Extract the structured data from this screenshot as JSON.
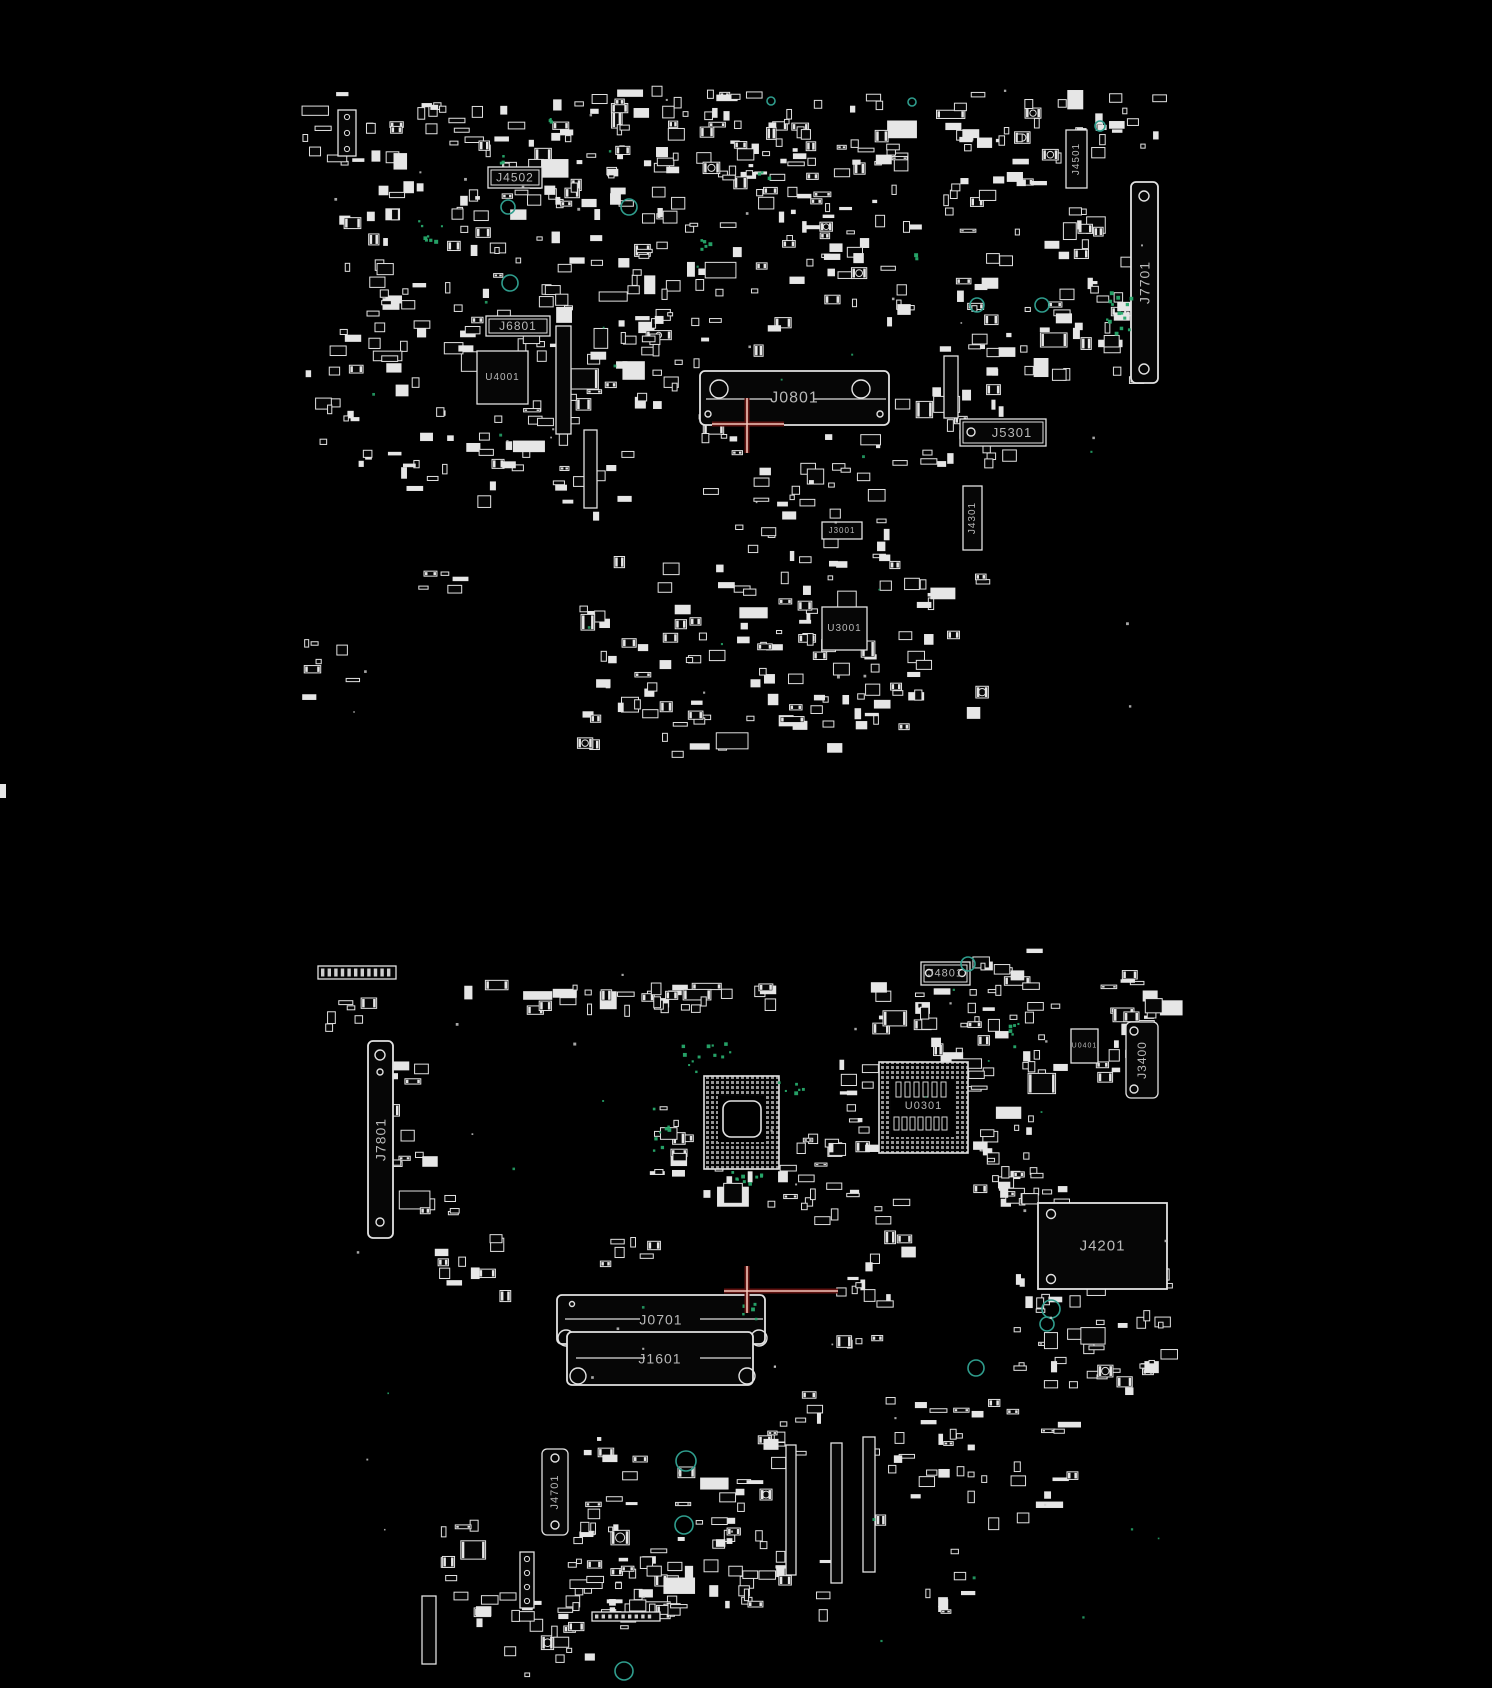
{
  "canvas": {
    "width": 1492,
    "height": 1688,
    "background": "#000000"
  },
  "palette": {
    "outline": "#e2e2e2",
    "fill_dim": "#060606",
    "label": "#b9b9b9",
    "ring_teal": "#2f9d8d",
    "dot_green": "#27a96c",
    "crosshair_core": "#f3c5b9",
    "crosshair_glow": "#5f1210"
  },
  "edge_marks": [
    [
      0,
      784,
      6,
      14
    ]
  ],
  "boards": [
    {
      "name": "top-side",
      "components": [
        {
          "label": "J4502",
          "kind": "labelbox",
          "dbl": true,
          "x": 488,
          "y": 167,
          "w": 54,
          "h": 21,
          "fs": 12
        },
        {
          "label": "J6801",
          "kind": "labelbox",
          "dbl": true,
          "x": 486,
          "y": 316,
          "w": 64,
          "h": 20,
          "fs": 12
        },
        {
          "label": "U4001",
          "kind": "chip",
          "x": 477,
          "y": 351,
          "w": 51,
          "h": 53,
          "fs": 10
        },
        {
          "label": "J0801",
          "kind": "sodimm",
          "x": 700,
          "y": 371,
          "w": 189,
          "h": 54,
          "fs": 16,
          "circles": [
            [
              719,
              389,
              9
            ],
            [
              861,
              389,
              9
            ],
            [
              708,
              414,
              3
            ],
            [
              880,
              414,
              3
            ]
          ],
          "lines": [
            [
              706,
              399,
              772,
              399
            ],
            [
              814,
              399,
              886,
              399
            ]
          ]
        },
        {
          "label": "J3001",
          "kind": "labelbox",
          "x": 822,
          "y": 522,
          "w": 40,
          "h": 17,
          "fs": 8
        },
        {
          "label": "U3001",
          "kind": "chip",
          "x": 822,
          "y": 607,
          "w": 45,
          "h": 43,
          "fs": 10
        },
        {
          "label": "J5301",
          "kind": "labelbox",
          "dbl": true,
          "x": 960,
          "y": 419,
          "w": 86,
          "h": 27,
          "fs": 13,
          "circles": [
            [
              971,
              432,
              4
            ]
          ],
          "lx": 1012
        },
        {
          "label": "J4301",
          "kind": "vbox",
          "x": 963,
          "y": 486,
          "w": 19,
          "h": 64,
          "fs": 10
        },
        {
          "label": "J4501",
          "kind": "vbox",
          "x": 1066,
          "y": 130,
          "w": 21,
          "h": 58,
          "fs": 10
        },
        {
          "label": "J7701",
          "kind": "vheader",
          "x": 1131,
          "y": 182,
          "w": 27,
          "h": 201,
          "fs": 14,
          "circles": [
            [
              1144,
              196,
              5
            ],
            [
              1144,
              369,
              5
            ]
          ]
        }
      ],
      "crosshair": {
        "x": 747,
        "y": 424,
        "left": 35,
        "right": 37,
        "up": 26,
        "down": 29
      },
      "rings": [
        [
          508,
          207,
          7
        ],
        [
          629,
          207,
          8
        ],
        [
          510,
          283,
          8
        ],
        [
          977,
          305,
          7
        ],
        [
          1042,
          305,
          7
        ],
        [
          912,
          102,
          4
        ],
        [
          1100,
          126,
          5
        ],
        [
          771,
          101,
          4
        ]
      ],
      "green_regions": [
        [
          418,
          218,
          26,
          26,
          8,
          301
        ],
        [
          1106,
          288,
          24,
          44,
          14,
          302
        ],
        [
          694,
          236,
          18,
          18,
          5,
          303
        ],
        [
          497,
          153,
          8,
          12,
          3,
          304
        ],
        [
          545,
          118,
          10,
          8,
          3,
          305
        ],
        [
          756,
          170,
          14,
          10,
          3,
          306
        ],
        [
          905,
          250,
          12,
          10,
          3,
          307
        ]
      ],
      "green_sparse": {
        "count": 14,
        "region": [
          330,
          90,
          820,
          620
        ],
        "seed": 21
      },
      "white_dots": {
        "count": 26,
        "region": [
          300,
          86,
          860,
          640
        ],
        "seed": 7
      },
      "bars": [
        [
          556,
          326,
          15,
          108,
          0
        ],
        [
          584,
          430,
          13,
          78,
          0
        ],
        [
          944,
          356,
          14,
          62,
          0
        ],
        [
          338,
          110,
          18,
          46,
          1
        ]
      ],
      "clusters": [
        [
          300,
          92,
          70,
          72,
          10,
          101
        ],
        [
          365,
          96,
          200,
          122,
          55,
          102
        ],
        [
          560,
          86,
          120,
          130,
          40,
          103
        ],
        [
          660,
          90,
          250,
          140,
          90,
          104
        ],
        [
          935,
          90,
          165,
          130,
          40,
          105
        ],
        [
          1085,
          92,
          70,
          65,
          12,
          106
        ],
        [
          330,
          215,
          240,
          138,
          60,
          107
        ],
        [
          575,
          235,
          215,
          125,
          45,
          108
        ],
        [
          800,
          228,
          110,
          95,
          20,
          109
        ],
        [
          950,
          215,
          175,
          155,
          48,
          110
        ],
        [
          300,
          352,
          115,
          135,
          22,
          111
        ],
        [
          420,
          388,
          150,
          115,
          28,
          112
        ],
        [
          556,
          330,
          70,
          190,
          16,
          113
        ],
        [
          622,
          336,
          95,
          82,
          15,
          114
        ],
        [
          890,
          342,
          115,
          120,
          26,
          115
        ],
        [
          700,
          432,
          185,
          125,
          38,
          116
        ],
        [
          575,
          556,
          215,
          162,
          50,
          117
        ],
        [
          795,
          556,
          185,
          165,
          48,
          118
        ],
        [
          575,
          690,
          170,
          66,
          15,
          119
        ],
        [
          770,
          690,
          130,
          62,
          13,
          120
        ],
        [
          300,
          606,
          56,
          92,
          7,
          121
        ],
        [
          418,
          568,
          42,
          42,
          5,
          122
        ],
        [
          1088,
          295,
          48,
          88,
          8,
          123
        ]
      ]
    },
    {
      "name": "bottom-side",
      "components": [
        {
          "label": "J4801",
          "kind": "labelbox",
          "dbl": true,
          "x": 921,
          "y": 962,
          "w": 49,
          "h": 23,
          "fs": 11,
          "circles": [
            [
              929,
              973,
              3.5
            ],
            [
              962,
              973,
              3.5
            ]
          ]
        },
        {
          "label": "U0401",
          "kind": "chip",
          "x": 1071,
          "y": 1029,
          "w": 27,
          "h": 34,
          "fs": 7
        },
        {
          "label": "J3400",
          "kind": "vheader",
          "x": 1126,
          "y": 1022,
          "w": 32,
          "h": 76,
          "fs": 12,
          "circles": [
            [
              1134,
              1031,
              4
            ],
            [
              1134,
              1089,
              4
            ]
          ]
        },
        {
          "label": "U0301",
          "kind": "bga",
          "x": 879,
          "y": 1062,
          "w": 89,
          "h": 91,
          "fs": 11,
          "ly": 1106,
          "inner_fill": [
            891,
            1079,
            64,
            58
          ],
          "inner_rects": [
            [
              896,
              1082,
              5,
              15
            ],
            [
              905,
              1082,
              5,
              15
            ],
            [
              914,
              1082,
              5,
              15
            ],
            [
              923,
              1082,
              5,
              15
            ],
            [
              932,
              1082,
              5,
              15
            ],
            [
              941,
              1082,
              5,
              15
            ],
            [
              894,
              1117,
              5,
              13
            ],
            [
              902,
              1117,
              5,
              13
            ],
            [
              910,
              1117,
              5,
              13
            ],
            [
              918,
              1117,
              5,
              13
            ],
            [
              926,
              1117,
              5,
              13
            ],
            [
              934,
              1117,
              5,
              13
            ],
            [
              942,
              1117,
              5,
              13
            ]
          ]
        },
        {
          "label": "",
          "kind": "bga",
          "x": 704,
          "y": 1076,
          "w": 75,
          "h": 93,
          "fs": 9,
          "inner_fill": [
            718,
            1096,
            48,
            46
          ],
          "inner_round": [
            723,
            1101,
            38,
            36
          ]
        },
        {
          "label": "J7801",
          "kind": "vheader",
          "x": 368,
          "y": 1041,
          "w": 25,
          "h": 197,
          "fs": 14,
          "circles": [
            [
              380,
              1055,
              5
            ],
            [
              380,
              1072,
              3
            ],
            [
              380,
              1222,
              4
            ]
          ]
        },
        {
          "label": "J4201",
          "kind": "bigconn",
          "x": 1038,
          "y": 1203,
          "w": 129,
          "h": 86,
          "fs": 15,
          "circles": [
            [
              1051,
              1214,
              4.5
            ],
            [
              1051,
              1279,
              4.5
            ]
          ]
        },
        {
          "label": "J0701",
          "kind": "sodimm",
          "x": 557,
          "y": 1295,
          "w": 208,
          "h": 49,
          "fs": 14,
          "circles": [
            [
              566,
              1338,
              8
            ],
            [
              759,
              1338,
              8
            ],
            [
              572,
              1304,
              2.5
            ]
          ],
          "lines": [
            [
              565,
              1319,
              640,
              1319
            ],
            [
              700,
              1319,
              763,
              1319
            ]
          ]
        },
        {
          "label": "J1601",
          "kind": "sodimm",
          "x": 567,
          "y": 1332,
          "w": 186,
          "h": 53,
          "fs": 14,
          "circles": [
            [
              578,
              1376,
              8
            ],
            [
              747,
              1376,
              8
            ]
          ],
          "lines": [
            [
              576,
              1358,
              645,
              1358
            ],
            [
              700,
              1358,
              751,
              1358
            ]
          ]
        },
        {
          "label": "J4701",
          "kind": "vheader",
          "x": 542,
          "y": 1449,
          "w": 26,
          "h": 86,
          "fs": 11,
          "circles": [
            [
              555,
              1458,
              4
            ],
            [
              555,
              1525,
              4
            ]
          ]
        }
      ],
      "crosshair": {
        "x": 747,
        "y": 1291,
        "left": 23,
        "right": 91,
        "up": 25,
        "down": 22
      },
      "rings": [
        [
          1051,
          1309,
          9
        ],
        [
          1047,
          1324,
          7
        ],
        [
          976,
          1368,
          8
        ],
        [
          686,
          1461,
          10
        ],
        [
          684,
          1525,
          9
        ],
        [
          624,
          1671,
          9
        ],
        [
          968,
          964,
          7
        ]
      ],
      "green_regions": [
        [
          678,
          1040,
          52,
          34,
          12,
          311
        ],
        [
          728,
          1168,
          58,
          18,
          9,
          312
        ],
        [
          998,
          1016,
          20,
          30,
          6,
          313
        ],
        [
          776,
          1070,
          30,
          22,
          6,
          314
        ],
        [
          730,
          1302,
          30,
          16,
          5,
          315
        ],
        [
          652,
          1093,
          20,
          60,
          8,
          316
        ]
      ],
      "green_sparse": {
        "count": 14,
        "region": [
          330,
          950,
          840,
          700
        ],
        "seed": 23
      },
      "white_dots": {
        "count": 26,
        "region": [
          318,
          940,
          860,
          700
        ],
        "seed": 11
      },
      "bars": [
        [
          786,
          1445,
          10,
          130,
          0
        ],
        [
          831,
          1443,
          11,
          140,
          0
        ],
        [
          863,
          1437,
          12,
          135,
          0
        ],
        [
          318,
          966,
          78,
          13,
          2
        ],
        [
          592,
          1612,
          68,
          9,
          2
        ],
        [
          520,
          1552,
          14,
          56,
          1
        ],
        [
          422,
          1596,
          14,
          68,
          0
        ]
      ],
      "clusters": [
        [
          455,
          980,
          330,
          26,
          34,
          201
        ],
        [
          318,
          995,
          60,
          30,
          6,
          202
        ],
        [
          852,
          982,
          82,
          42,
          12,
          203
        ],
        [
          960,
          946,
          75,
          48,
          12,
          204
        ],
        [
          956,
          1002,
          98,
          72,
          22,
          205
        ],
        [
          1096,
          966,
          64,
          60,
          14,
          206
        ],
        [
          1094,
          1040,
          32,
          36,
          6,
          207
        ],
        [
          918,
          1028,
          58,
          62,
          12,
          208
        ],
        [
          645,
          1096,
          40,
          76,
          12,
          209
        ],
        [
          796,
          1120,
          44,
          102,
          16,
          210
        ],
        [
          836,
          1054,
          54,
          102,
          18,
          211
        ],
        [
          971,
          1106,
          64,
          94,
          18,
          212
        ],
        [
          986,
          1148,
          76,
          54,
          14,
          213
        ],
        [
          686,
          1163,
          98,
          44,
          10,
          214
        ],
        [
          374,
          1056,
          48,
          62,
          8,
          215
        ],
        [
          386,
          1126,
          66,
          88,
          12,
          216
        ],
        [
          424,
          1226,
          88,
          68,
          10,
          217
        ],
        [
          836,
          1186,
          66,
          158,
          22,
          218
        ],
        [
          1000,
          1266,
          172,
          128,
          45,
          219
        ],
        [
          872,
          1390,
          195,
          128,
          38,
          220
        ],
        [
          758,
          1390,
          64,
          70,
          12,
          221
        ],
        [
          570,
          1436,
          72,
          108,
          18,
          222
        ],
        [
          660,
          1452,
          104,
          92,
          20,
          223
        ],
        [
          563,
          1543,
          108,
          84,
          28,
          224
        ],
        [
          441,
          1510,
          30,
          112,
          8,
          225
        ],
        [
          468,
          1576,
          120,
          98,
          24,
          226
        ],
        [
          598,
          1560,
          90,
          60,
          14,
          227
        ],
        [
          700,
          1545,
          120,
          70,
          18,
          228
        ],
        [
          900,
          1540,
          70,
          70,
          8,
          229
        ],
        [
          592,
          1236,
          62,
          48,
          6,
          230
        ]
      ]
    }
  ]
}
